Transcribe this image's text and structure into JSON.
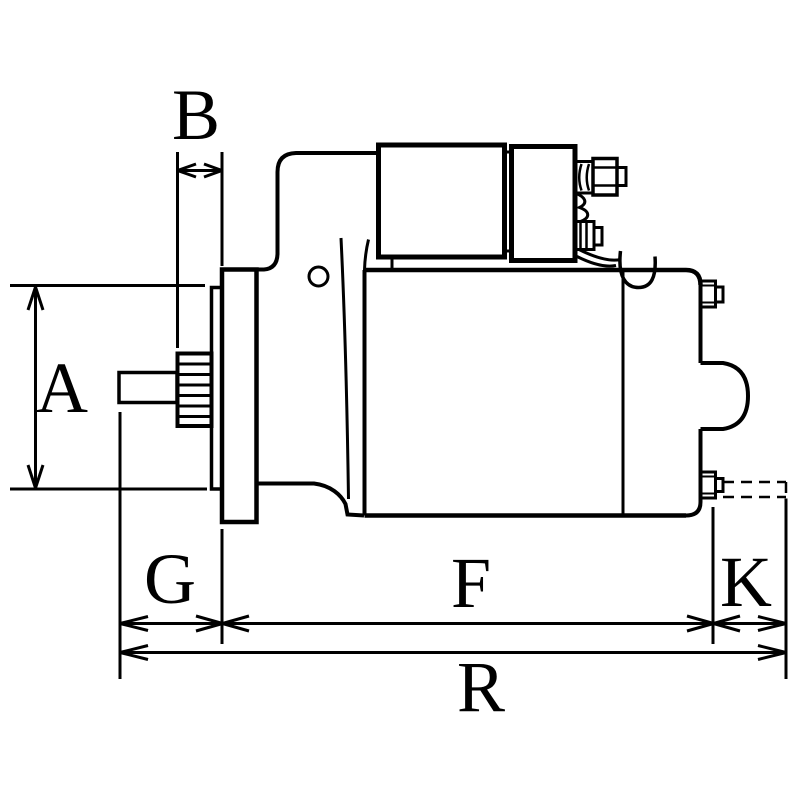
{
  "drawing": {
    "type": "technical-dimension-drawing",
    "subject": "starter-motor-side-view",
    "background_color": "#ffffff",
    "line_color": "#000000",
    "labels": {
      "a": "A",
      "b": "B",
      "g": "G",
      "f": "F",
      "k": "K",
      "r": "R"
    }
  }
}
